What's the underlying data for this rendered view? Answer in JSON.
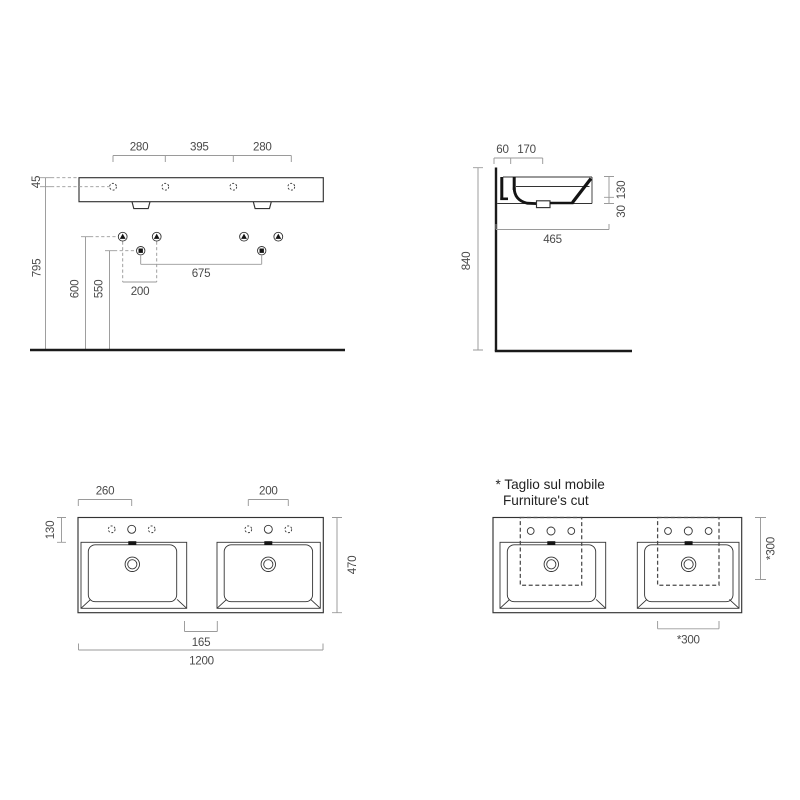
{
  "front": {
    "dim_span_left": "280",
    "dim_span_mid": "395",
    "dim_span_right": "280",
    "dim_rim_to_hole": "45",
    "dim_floor_to_rim": "795",
    "dim_600": "600",
    "dim_550": "550",
    "dim_675": "675",
    "dim_200": "200"
  },
  "side": {
    "dim_60": "60",
    "dim_170": "170",
    "dim_840": "840",
    "dim_130": "130",
    "dim_30": "30",
    "dim_465": "465"
  },
  "plan": {
    "dim_260": "260",
    "dim_200": "200",
    "dim_130": "130",
    "dim_470": "470",
    "dim_165": "165",
    "dim_1200": "1200"
  },
  "cut": {
    "note_line1": "* Taglio sul mobile",
    "note_line2": "Furniture's cut",
    "dim_300_right": "*300",
    "dim_300_bottom": "*300"
  },
  "colors": {
    "line": "#333333",
    "heavy_line": "#1a1a1a",
    "dimension_line": "#9a9a9a",
    "dimension_text": "#4a4a4a",
    "note_text": "#222222",
    "background": "#ffffff"
  }
}
